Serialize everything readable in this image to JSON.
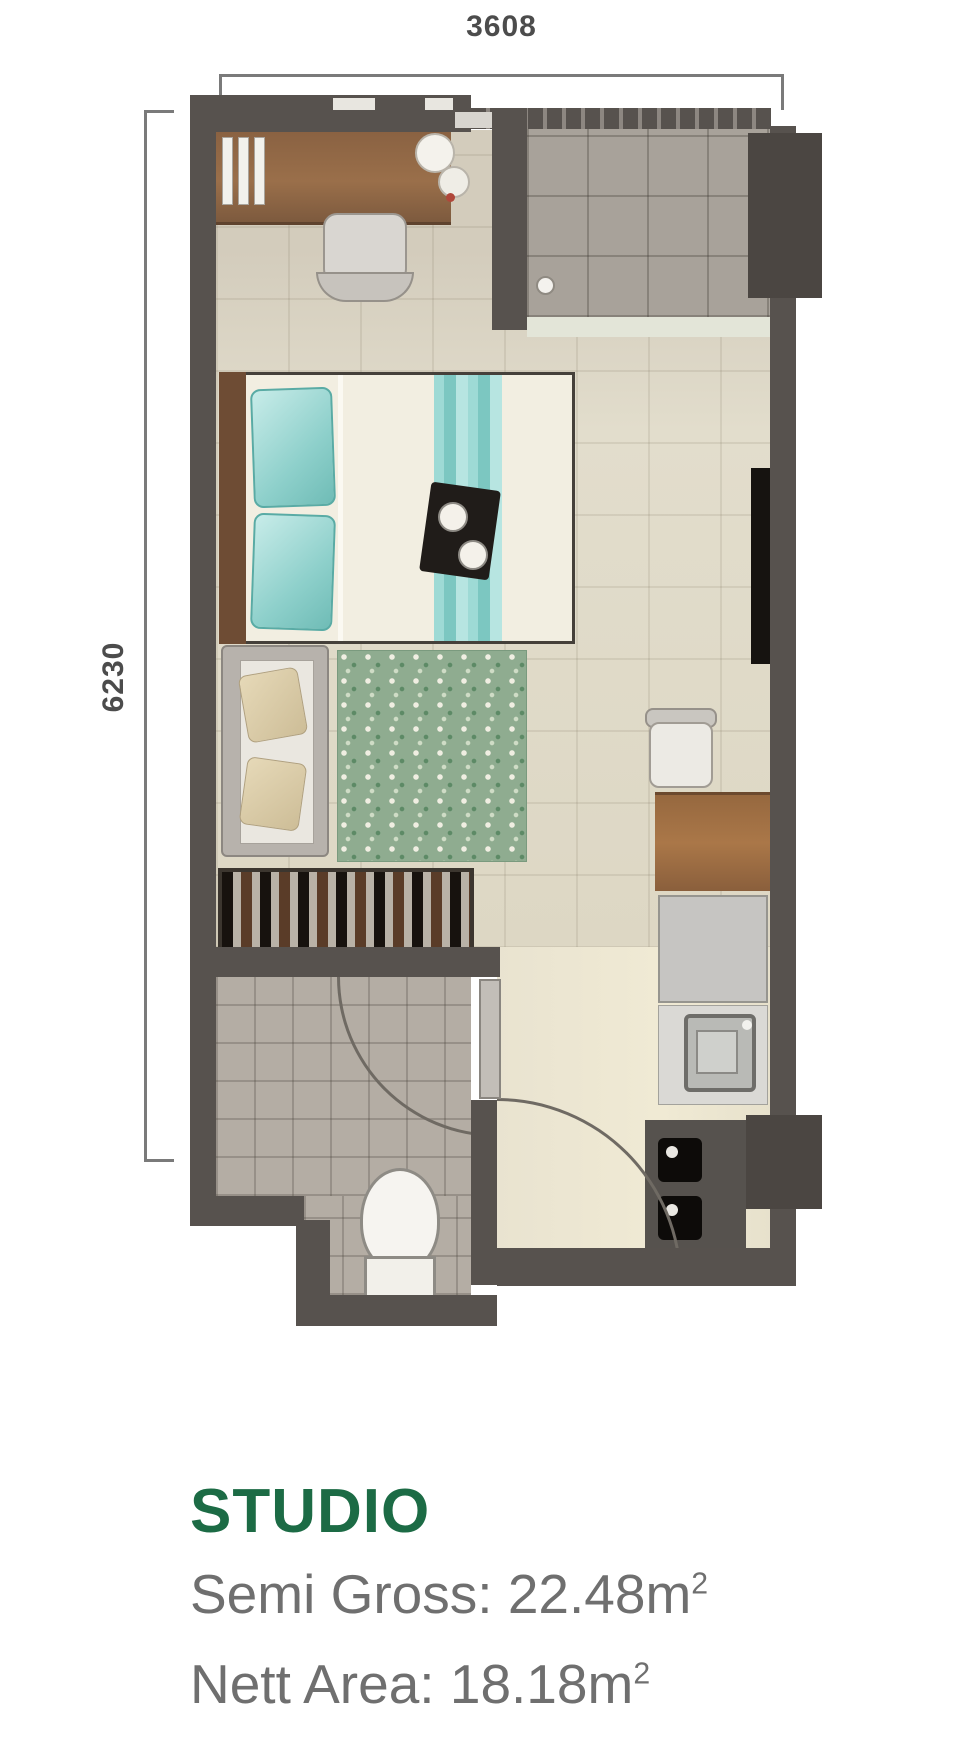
{
  "dimensions": {
    "width_label": "3608",
    "height_label": "6230"
  },
  "title": {
    "text": "STUDIO",
    "color": "#1c6b45"
  },
  "areas": {
    "semi_gross": {
      "text": "Semi Gross: 22.48m",
      "sup": "2"
    },
    "nett": {
      "text": "Nett Area: 18.18m",
      "sup": "2"
    }
  },
  "palette": {
    "wall": "#57524e",
    "floor_main": "#ddd7c4",
    "floor_foyer": "#a8a29a",
    "floor_bath": "#b4ada4",
    "accent_teal": "#8ed0cb",
    "rug_green": "#8fac90",
    "wood": "#9a6f4a",
    "title_green": "#1c6b45",
    "text_gray": "#6f6f6f"
  },
  "furniture": [
    "desk",
    "office-chair",
    "blinds",
    "bed",
    "pillows",
    "bed-runner",
    "serving-tray",
    "sofa",
    "rug",
    "wardrobe",
    "side-desk",
    "side-chair",
    "fridge",
    "kitchen-sink",
    "stove",
    "toilet"
  ]
}
